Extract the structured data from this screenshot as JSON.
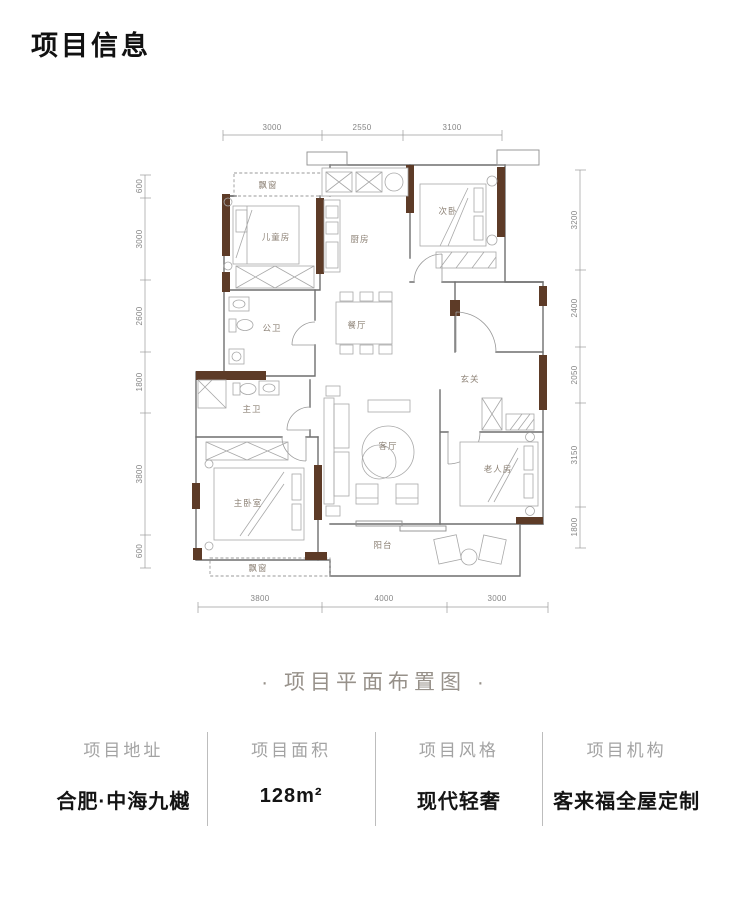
{
  "title": "项目信息",
  "caption": "· 项目平面布置图 ·",
  "floorplan": {
    "rooms": {
      "bay_window_top": "飘窗",
      "children_room": "儿童房",
      "kitchen": "厨房",
      "second_bedroom": "次卧",
      "public_bath": "公卫",
      "dining_room": "餐厅",
      "foyer": "玄关",
      "master_bath": "主卫",
      "living_room": "客厅",
      "elder_room": "老人房",
      "master_bedroom": "主卧室",
      "bay_window_bottom": "飘窗",
      "balcony": "阳台"
    },
    "dimensions_mm": {
      "top": [
        "3000",
        "2550",
        "3100"
      ],
      "bottom": [
        "3800",
        "4000",
        "3000"
      ],
      "left": [
        "600",
        "3000",
        "2600",
        "1800",
        "3800",
        "600"
      ],
      "right": [
        "3200",
        "2400",
        "2050",
        "3150",
        "1800"
      ]
    },
    "colors": {
      "wall_accent": "#5d3b27",
      "line": "#6f6f6f",
      "dim_text": "#858585"
    }
  },
  "footer": {
    "columns": [
      {
        "label": "项目地址",
        "value": "合肥·中海九樾"
      },
      {
        "label": "项目面积",
        "value": "128m²"
      },
      {
        "label": "项目风格",
        "value": "现代轻奢"
      },
      {
        "label": "项目机构",
        "value": "客来福全屋定制"
      }
    ]
  }
}
